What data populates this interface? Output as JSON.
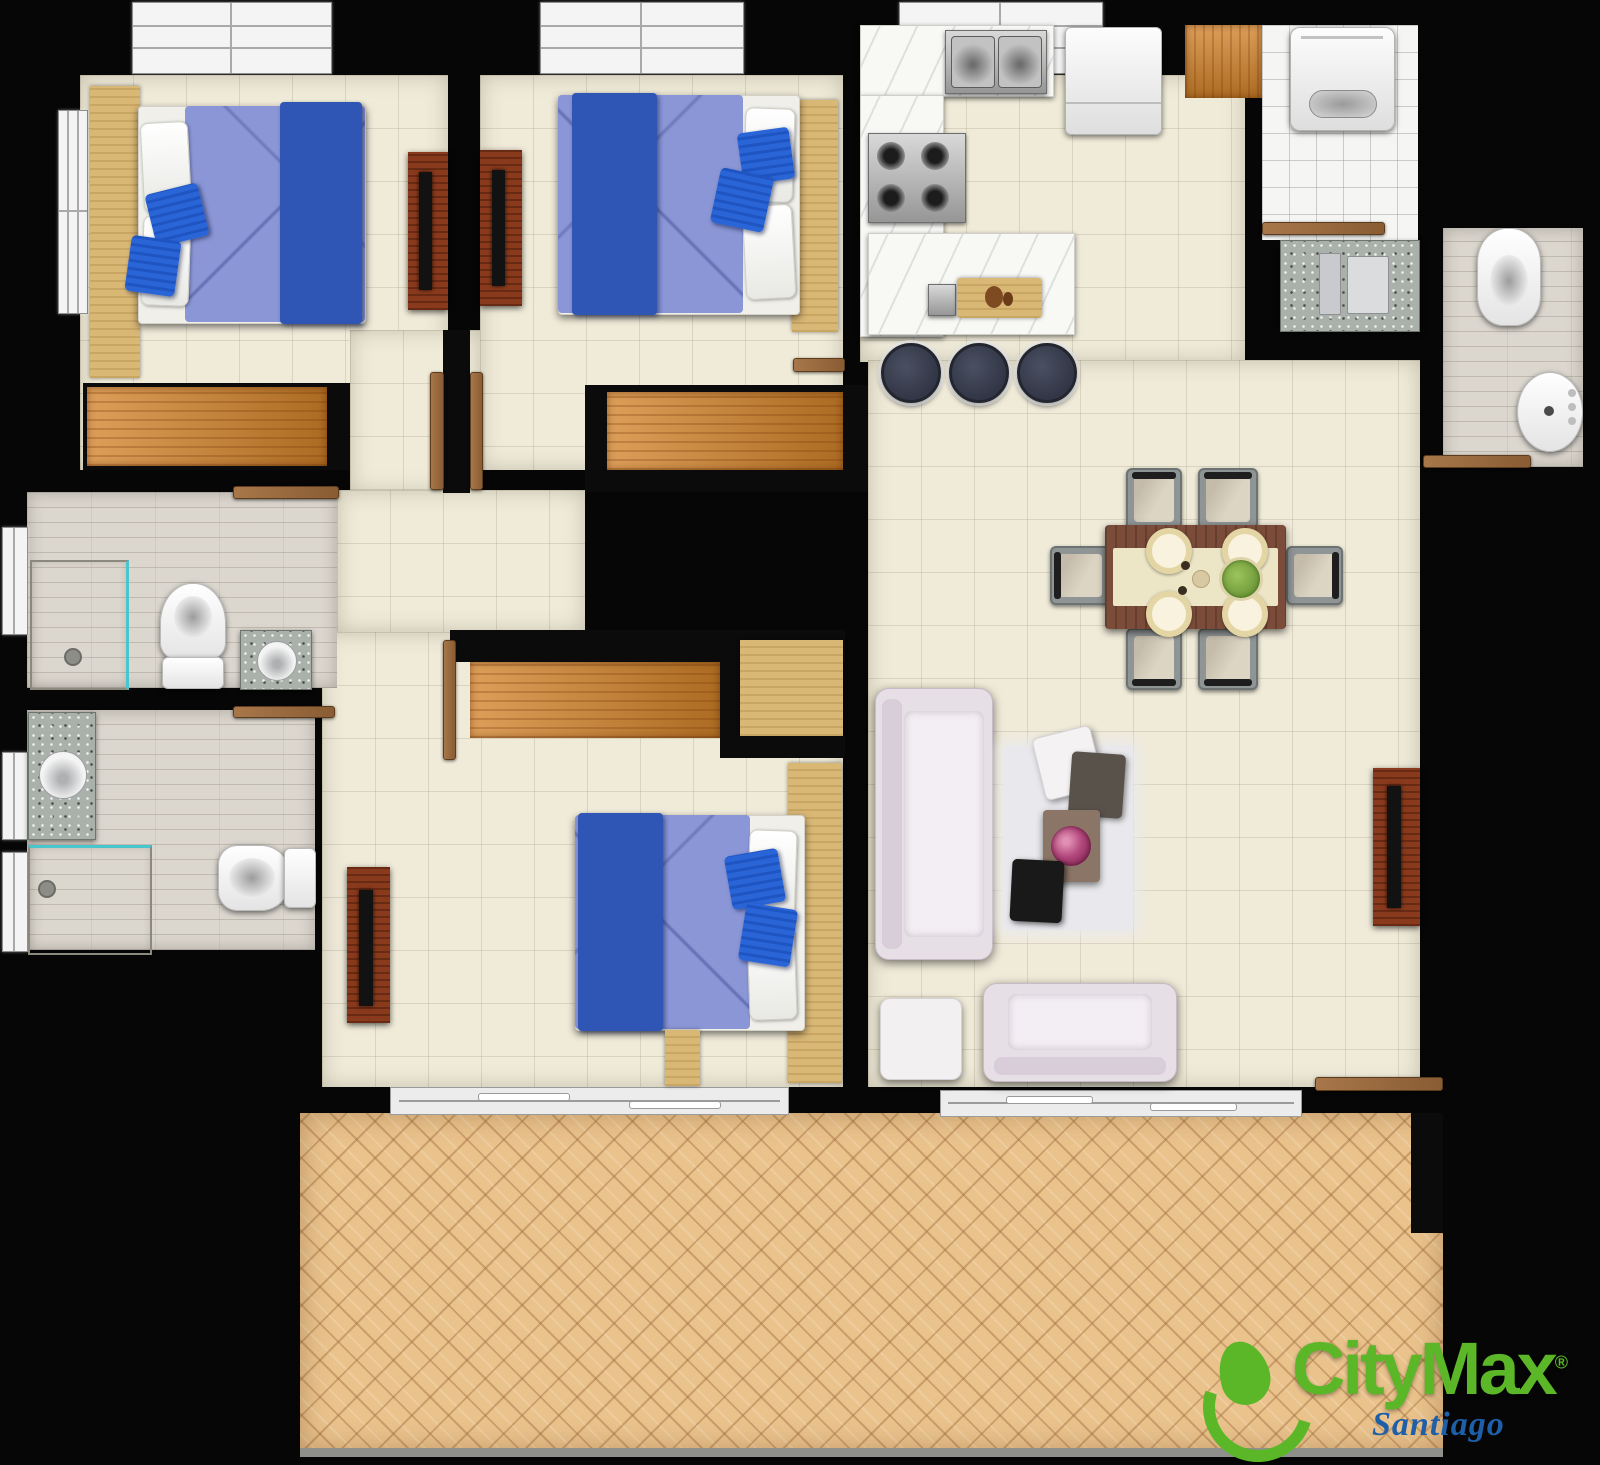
{
  "brand": {
    "name": "CityMax",
    "registered": "®",
    "city": "Santiago",
    "green": "#5cb728",
    "blue": "#1d5fa8"
  },
  "palette": {
    "walls": "#060606",
    "interior_tile": "#f0ebd9",
    "terrace_parquet": "#eac28c",
    "closet_wood": "#d2832a",
    "light_wood": "#d9b876",
    "dark_wood_console": "#8a3a1c",
    "bed_sheet": "#8a96d6",
    "bed_blanket": "#2f55b5",
    "accent_pillow": "#2a65d8",
    "sofa": "#e6dfe6",
    "rug": "#e9e9ed",
    "bathroom_floor": "#dbd6ce",
    "granite_counter": "#aab1ab",
    "dining_table": "#7b4c3a",
    "bar_stool": "#363a48"
  },
  "rooms": {
    "list": [
      "bedroom-1",
      "bedroom-2",
      "master-bedroom",
      "bathroom-1",
      "bathroom-2",
      "bathroom-3",
      "kitchen",
      "laundry",
      "dining-area",
      "living-room",
      "hallway",
      "terrace"
    ]
  }
}
